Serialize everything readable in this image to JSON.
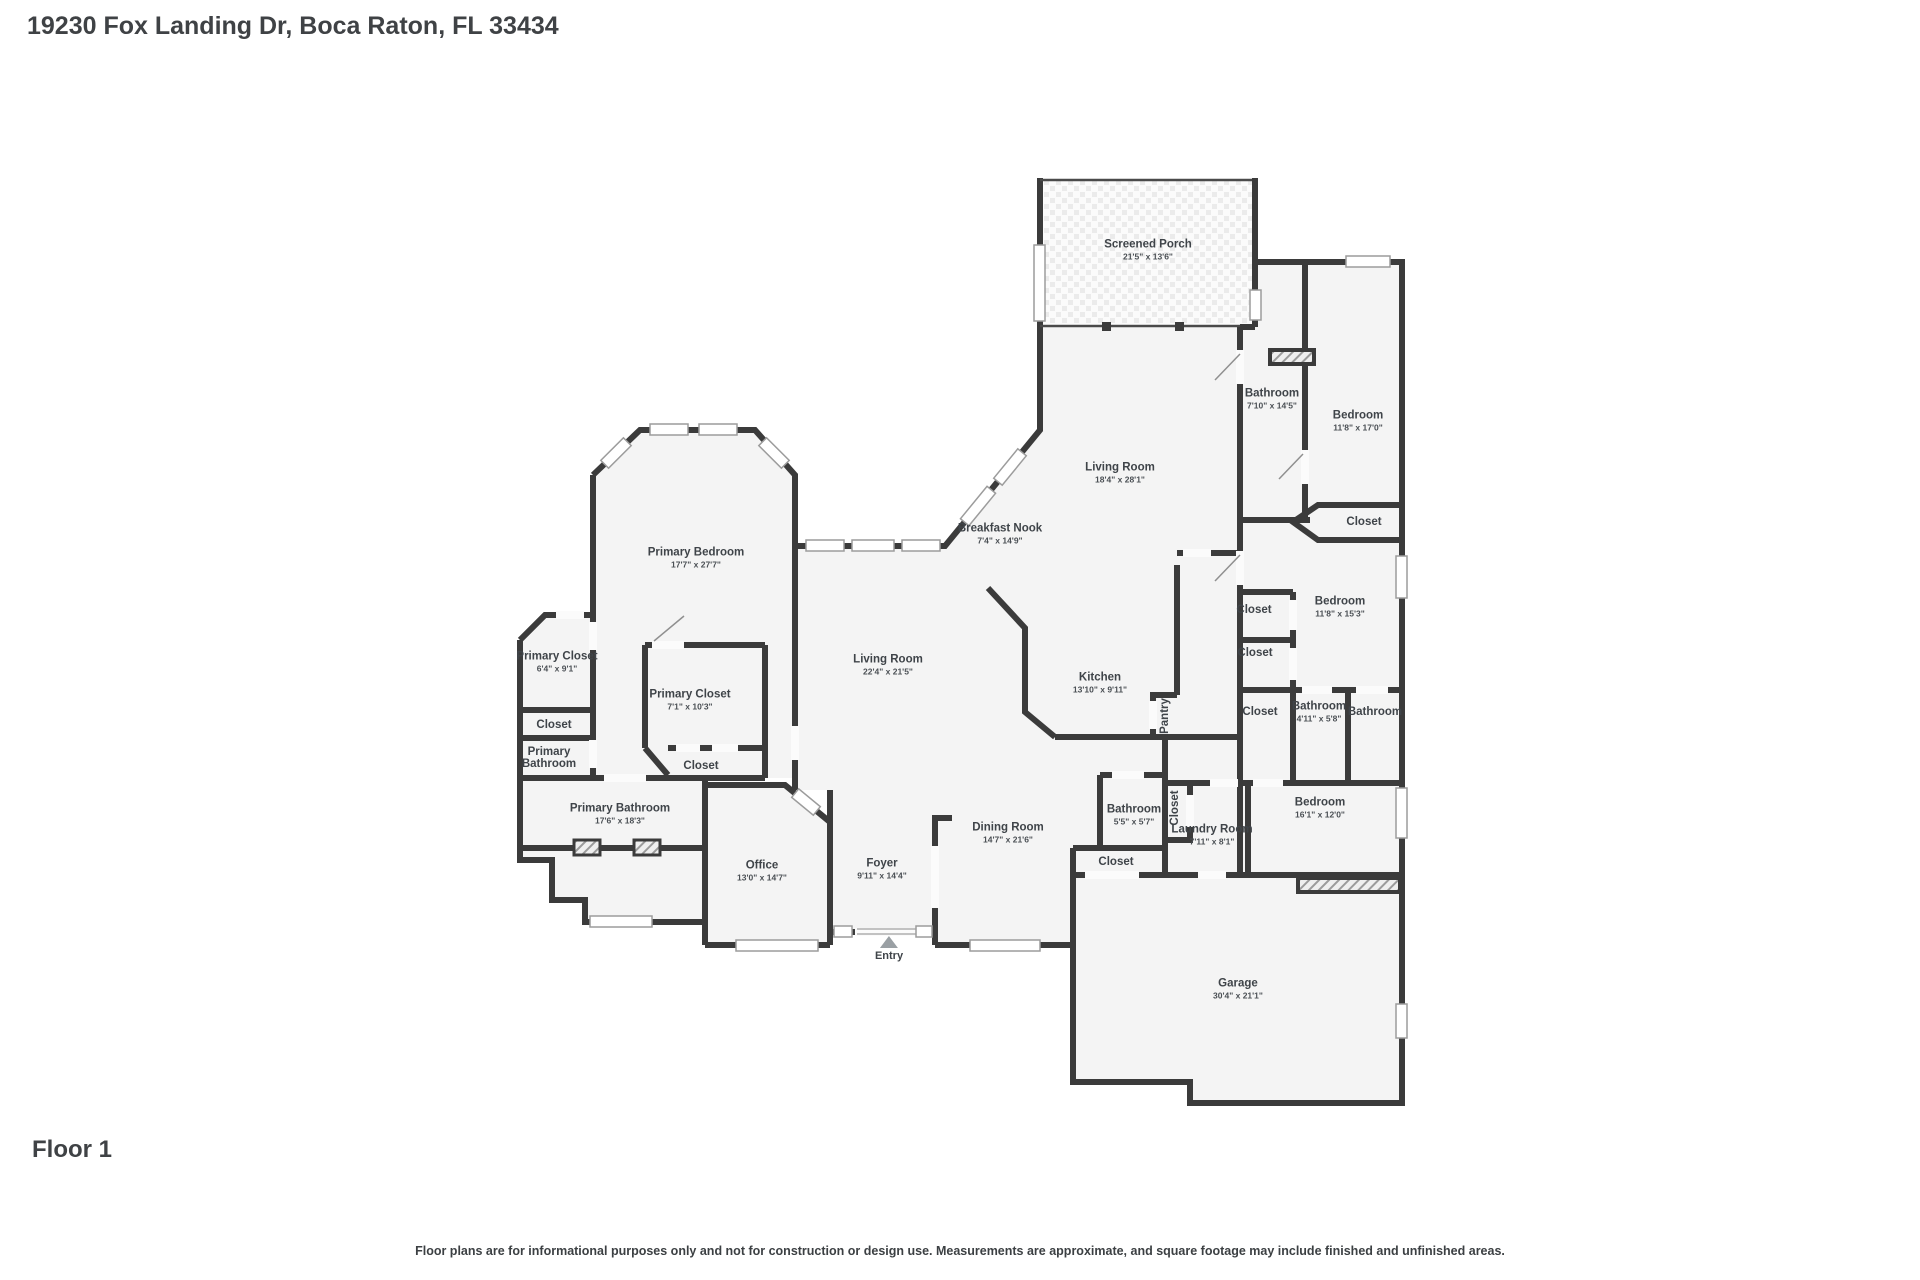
{
  "page": {
    "address_title": "19230 Fox Landing Dr, Boca Raton, FL 33434",
    "floor_label": "Floor 1",
    "disclaimer": "Floor plans are for informational purposes only and not for construction or design use. Measurements are approximate, and square footage may include finished and unfinished areas."
  },
  "colors": {
    "wall": "#3b3b3b",
    "room_fill": "#f4f4f4",
    "background": "#ffffff",
    "label_text": "#3f4449",
    "window_outline": "#9c9c9c",
    "entry_marker": "#9aa0a4"
  },
  "floorplan": {
    "entry": {
      "label": "Entry",
      "x": 889,
      "y": 936
    },
    "rooms": [
      {
        "id": "screened-porch",
        "name": "Screened Porch",
        "dims": "21'5\" x 13'6\"",
        "x": 1148,
        "y": 250
      },
      {
        "id": "bathroom-1",
        "name": "Bathroom",
        "dims": "7'10\" x 14'5\"",
        "x": 1272,
        "y": 399
      },
      {
        "id": "bedroom-1",
        "name": "Bedroom",
        "dims": "11'8\" x 17'0\"",
        "x": 1358,
        "y": 421
      },
      {
        "id": "closet-bedroom-1",
        "name": "Closet",
        "dims": "",
        "x": 1364,
        "y": 522
      },
      {
        "id": "living-room-upper",
        "name": "Living Room",
        "dims": "18'4\" x 28'1\"",
        "x": 1120,
        "y": 473
      },
      {
        "id": "breakfast-nook",
        "name": "Breakfast Nook",
        "dims": "7'4\" x 14'9\"",
        "x": 1000,
        "y": 534
      },
      {
        "id": "primary-bedroom",
        "name": "Primary Bedroom",
        "dims": "17'7\" x 27'7\"",
        "x": 696,
        "y": 558
      },
      {
        "id": "primary-closet-1",
        "name": "Primary Closet",
        "dims": "6'4\" x 9'1\"",
        "x": 557,
        "y": 662
      },
      {
        "id": "closet-left",
        "name": "Closet",
        "dims": "",
        "x": 554,
        "y": 725
      },
      {
        "id": "primary-bathroom-small",
        "name": "Primary Bathroom",
        "dims": "",
        "x": 549,
        "y": 758,
        "narrow": true
      },
      {
        "id": "primary-closet-2",
        "name": "Primary Closet",
        "dims": "7'1\" x 10'3\"",
        "x": 690,
        "y": 700
      },
      {
        "id": "closet-primary-2",
        "name": "Closet",
        "dims": "",
        "x": 701,
        "y": 766
      },
      {
        "id": "living-room-main",
        "name": "Living Room",
        "dims": "22'4\" x 21'5\"",
        "x": 888,
        "y": 665
      },
      {
        "id": "kitchen",
        "name": "Kitchen",
        "dims": "13'10\" x 9'11\"",
        "x": 1100,
        "y": 683
      },
      {
        "id": "pantry",
        "name": "Pantry",
        "dims": "",
        "x": 1165,
        "y": 716,
        "vertical": true
      },
      {
        "id": "closet-bedroom-2a",
        "name": "Closet",
        "dims": "",
        "x": 1254,
        "y": 610
      },
      {
        "id": "bedroom-2",
        "name": "Bedroom",
        "dims": "11'8\" x 15'3\"",
        "x": 1340,
        "y": 607
      },
      {
        "id": "closet-bedroom-2b",
        "name": "Closet",
        "dims": "",
        "x": 1255,
        "y": 653
      },
      {
        "id": "closet-hall-east",
        "name": "Closet",
        "dims": "",
        "x": 1260,
        "y": 712
      },
      {
        "id": "bathroom-2",
        "name": "Bathroom",
        "dims": "4'11\" x 5'8\"",
        "x": 1319,
        "y": 712
      },
      {
        "id": "bathroom-3",
        "name": "Bathroom",
        "dims": "",
        "x": 1375,
        "y": 712
      },
      {
        "id": "bedroom-3",
        "name": "Bedroom",
        "dims": "16'1\" x 12'0\"",
        "x": 1320,
        "y": 808
      },
      {
        "id": "closet-laundry",
        "name": "Closet",
        "dims": "",
        "x": 1175,
        "y": 808,
        "vertical": true
      },
      {
        "id": "laundry-room",
        "name": "Laundry Room",
        "dims": "7'11\" x 8'1\"",
        "x": 1212,
        "y": 835
      },
      {
        "id": "bathroom-4",
        "name": "Bathroom",
        "dims": "5'5\" x 5'7\"",
        "x": 1134,
        "y": 815
      },
      {
        "id": "closet-hall-south",
        "name": "Closet",
        "dims": "",
        "x": 1116,
        "y": 862
      },
      {
        "id": "dining-room",
        "name": "Dining Room",
        "dims": "14'7\" x 21'6\"",
        "x": 1008,
        "y": 833
      },
      {
        "id": "foyer",
        "name": "Foyer",
        "dims": "9'11\" x 14'4\"",
        "x": 882,
        "y": 869
      },
      {
        "id": "office",
        "name": "Office",
        "dims": "13'0\" x 14'7\"",
        "x": 762,
        "y": 871
      },
      {
        "id": "primary-bathroom",
        "name": "Primary Bathroom",
        "dims": "17'6\" x 18'3\"",
        "x": 620,
        "y": 814
      },
      {
        "id": "garage",
        "name": "Garage",
        "dims": "30'4\" x 21'1\"",
        "x": 1238,
        "y": 989
      }
    ]
  }
}
